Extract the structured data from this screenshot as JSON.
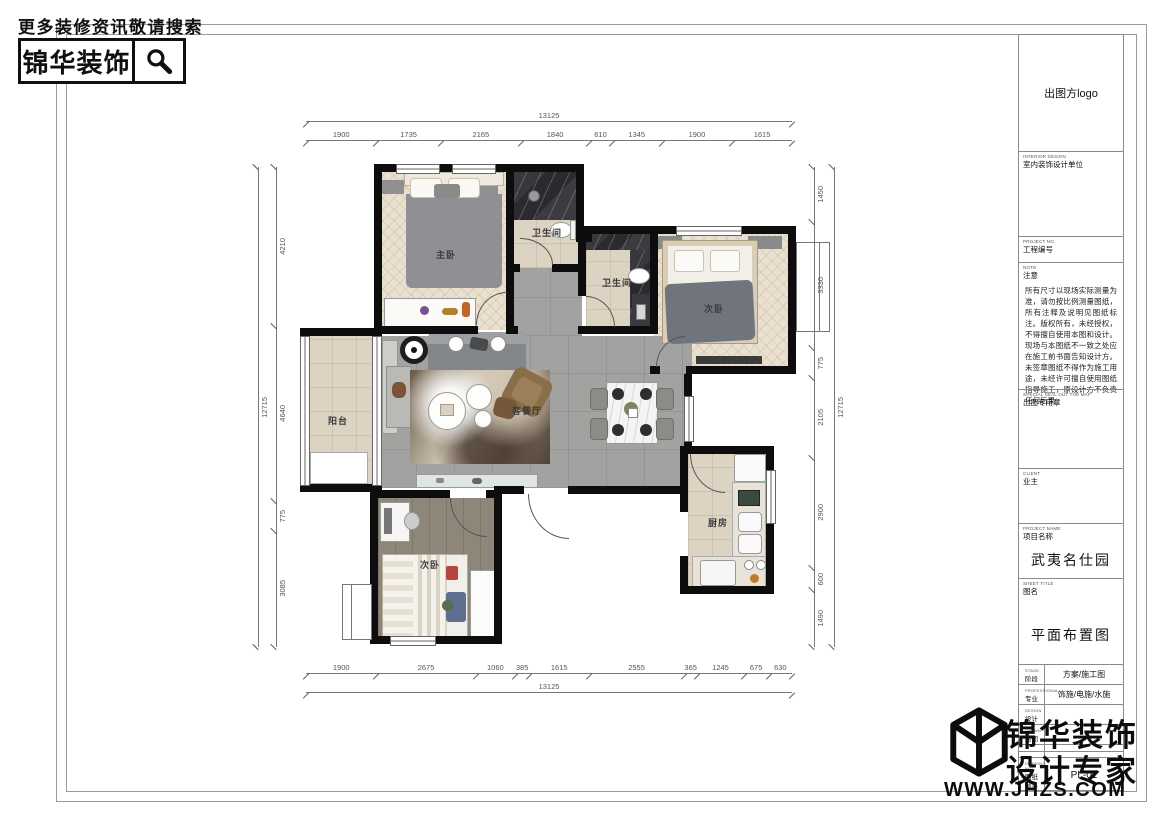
{
  "header": {
    "search_hint": "更多装修资讯敬请搜索",
    "brand": "锦华装饰"
  },
  "titleblock": {
    "logo_label": "出图方logo",
    "interior_design": {
      "en": "INTERIOR DESIGN",
      "zh": "室内装饰设计单位"
    },
    "project_no": {
      "en": "PROJECT NO.",
      "zh": "工程编号"
    },
    "note": {
      "en": "NOTE",
      "zh": "注意",
      "text": "所有尺寸以现场实际测量为准，请勿按比例测量图纸，所有注释及说明见图纸标注。版权所有，未经授权，不得擅自使用本图和设计。现场与本图纸不一致之处应在施工前书面告知设计方。未签章图纸不得作为施工用途，未经许可擅自使用图纸指导施工，原设计方不负责任何后果。"
    },
    "seal": {
      "en": "SPECIAL SEAL OUT THE MAP",
      "zh": "出图专用章"
    },
    "client": {
      "en": "CLIENT",
      "zh": "业主"
    },
    "project_name": {
      "en": "PROJECT NAME",
      "zh": "项目名称",
      "value": "武夷名仕园"
    },
    "sheet_title": {
      "en": "SHEET TITLE",
      "zh": "图名",
      "value": "平面布置图"
    },
    "table": {
      "rows": [
        {
          "en": "STAGE",
          "zh": "阶段",
          "value": "方案/施工图"
        },
        {
          "en": "PROFESSIONAL",
          "zh": "专业",
          "value": "饰施/电施/水施"
        },
        {
          "en": "DESIGN",
          "zh": "设计",
          "value": ""
        },
        {
          "en": "DRAWN",
          "zh": "绘图",
          "value": ""
        },
        {
          "en": "",
          "zh": "",
          "value": ""
        },
        {
          "en": "",
          "zh": "",
          "value": ""
        },
        {
          "en": "DRAWING NO.",
          "zh": "图纸编号",
          "value": "PL-01"
        }
      ]
    }
  },
  "watermark": {
    "line1": "锦华装饰",
    "line2": "设计专家",
    "url": "WWW.JHZS.COM"
  },
  "plan": {
    "rooms": {
      "master": "主卧",
      "bath1": "卫生间",
      "bath2": "卫生间",
      "bedroom2": "次卧",
      "balcony": "阳台",
      "living": "客餐厅",
      "kitchen": "厨房",
      "bedroom3": "次卧"
    },
    "dims": {
      "top_total": "13125",
      "top_segments": [
        "1900",
        "1735",
        "2165",
        "1840",
        "610",
        "1345",
        "1900",
        "1615"
      ],
      "bottom_segments": [
        "1900",
        "2675",
        "1060",
        "385",
        "1615",
        "2555",
        "365",
        "1245",
        "675",
        "630"
      ],
      "bottom_total": "13125",
      "left_total": "12715",
      "left_segments": [
        "4210",
        "4640",
        "775",
        "3085"
      ],
      "right_segments": [
        "1450",
        "3330",
        "775",
        "2105",
        "2900",
        "600",
        "1490"
      ],
      "right_total": "12715"
    }
  }
}
